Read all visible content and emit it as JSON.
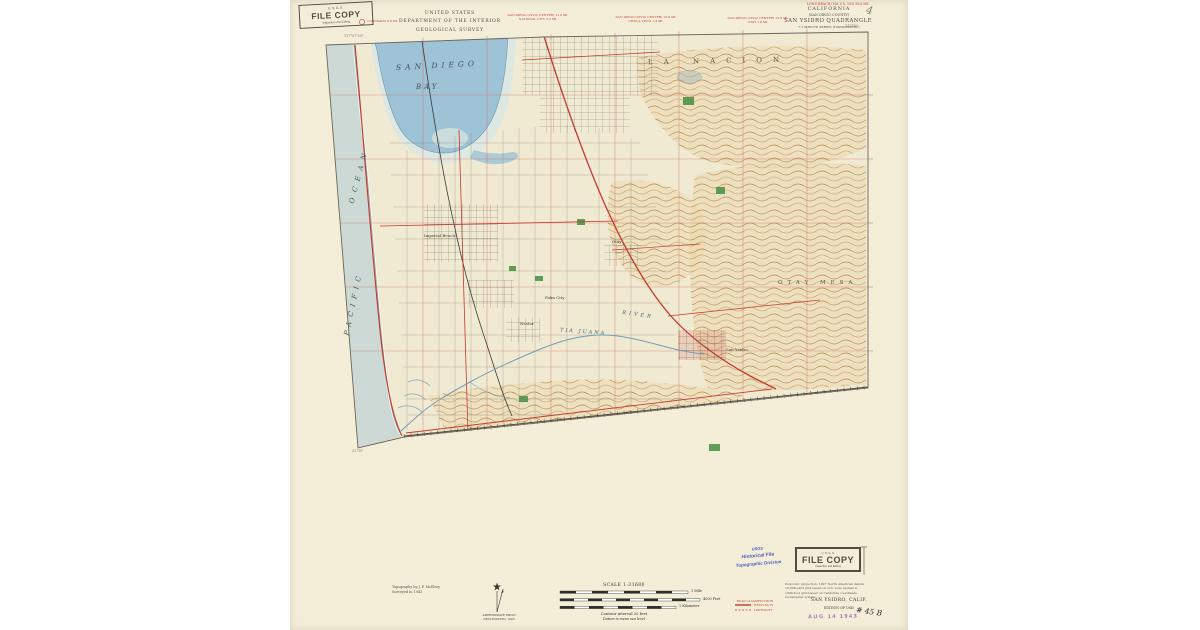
{
  "header": {
    "agency_line1": "UNITED STATES",
    "agency_line2": "DEPARTMENT OF THE INTERIOR",
    "agency_line3": "GEOLOGICAL SURVEY",
    "route_note": "LONG BEACH (VIA U.S. 101) 98.6 MI.",
    "state": "CALIFORNIA",
    "county": "(SAN DIEGO COUNTY)",
    "quadrangle": "SAN YSIDRO QUADRANGLE",
    "series": "7.5 MINUTE SERIES (TOPOGRAPHIC)"
  },
  "road_notes": [
    {
      "line1": "CORONADO 8.8 MI.",
      "line2": ""
    },
    {
      "line1": "SAN DIEGO (CIVIC CENTER) 11.6 MI.",
      "line2": "NATIONAL CITY 2.2 MI."
    },
    {
      "line1": "SAN DIEGO (CIVIC CENTER) 12.6 MI.",
      "line2": "CHULA VISTA 1.4 MI."
    },
    {
      "line1": "SAN DIEGO (CIVIC CENTER) 13.8 MI.",
      "line2": "OTAY 1.6 MI."
    }
  ],
  "coords": {
    "top_left": "117°07'30\"",
    "top_right": "117°00'",
    "bottom_left": "32°30'"
  },
  "map_labels": {
    "bay_line1": "SAN DIEGO",
    "bay_line2": "BAY",
    "ocean_word1": "PACIFIC",
    "ocean_word2": "OCEAN",
    "land_grant": "LA NACION",
    "mesa": "OTAY MESA",
    "river_word1": "TIA JUANA",
    "river_word2": "RIVER",
    "towns": [
      {
        "name": "Imperial Beach"
      },
      {
        "name": "Palm City"
      },
      {
        "name": "Nestor"
      },
      {
        "name": "Otay"
      },
      {
        "name": "San Ysidro"
      }
    ]
  },
  "footer": {
    "credit_line1": "Topography by J. P. McElroy",
    "credit_line2": "Surveyed in 1943",
    "declination_line1": "APPROXIMATE MEAN",
    "declination_line2": "DECLINATION, 1943",
    "scale_label": "SCALE 1:31680",
    "bar_mile": "1 Mile",
    "bar_feet": "4000 Feet",
    "bar_km": "1 Kilometer",
    "contour_note": "Contour interval 25 feet",
    "datum_note": "Datum is mean sea level",
    "projection_line1": "Polyconic projection. 1927 North American datum",
    "projection_line2": "10,000-yard grid based on U.S. zone system G",
    "projection_line3": "1000-foot grid based on California coordinate",
    "projection_line4": "rectangular system",
    "road_class_title": "ROAD CLASSIFICATION",
    "road_class_item1": "HEAVY-DUTY",
    "road_class_item2": "LIGHT-DUTY",
    "sheet_name": "SAN YSIDRO, CALIF.",
    "edition": "EDITION OF 1943"
  },
  "stamps": {
    "file_copy_top": {
      "agency": "U. S. G. S.",
      "title": "FILE COPY",
      "subtitle": "Inspection and Editing"
    },
    "file_copy_bottom": {
      "agency": "U. S. G. S.",
      "title": "FILE COPY",
      "subtitle": "Inspection and Editing"
    },
    "historical": {
      "line1": "USGS",
      "line2": "Historical File",
      "line3": "Topographic Division"
    },
    "date_received": "AUG 14 1943",
    "hand_number": "# 45 B",
    "pencil_mark": "4"
  }
}
